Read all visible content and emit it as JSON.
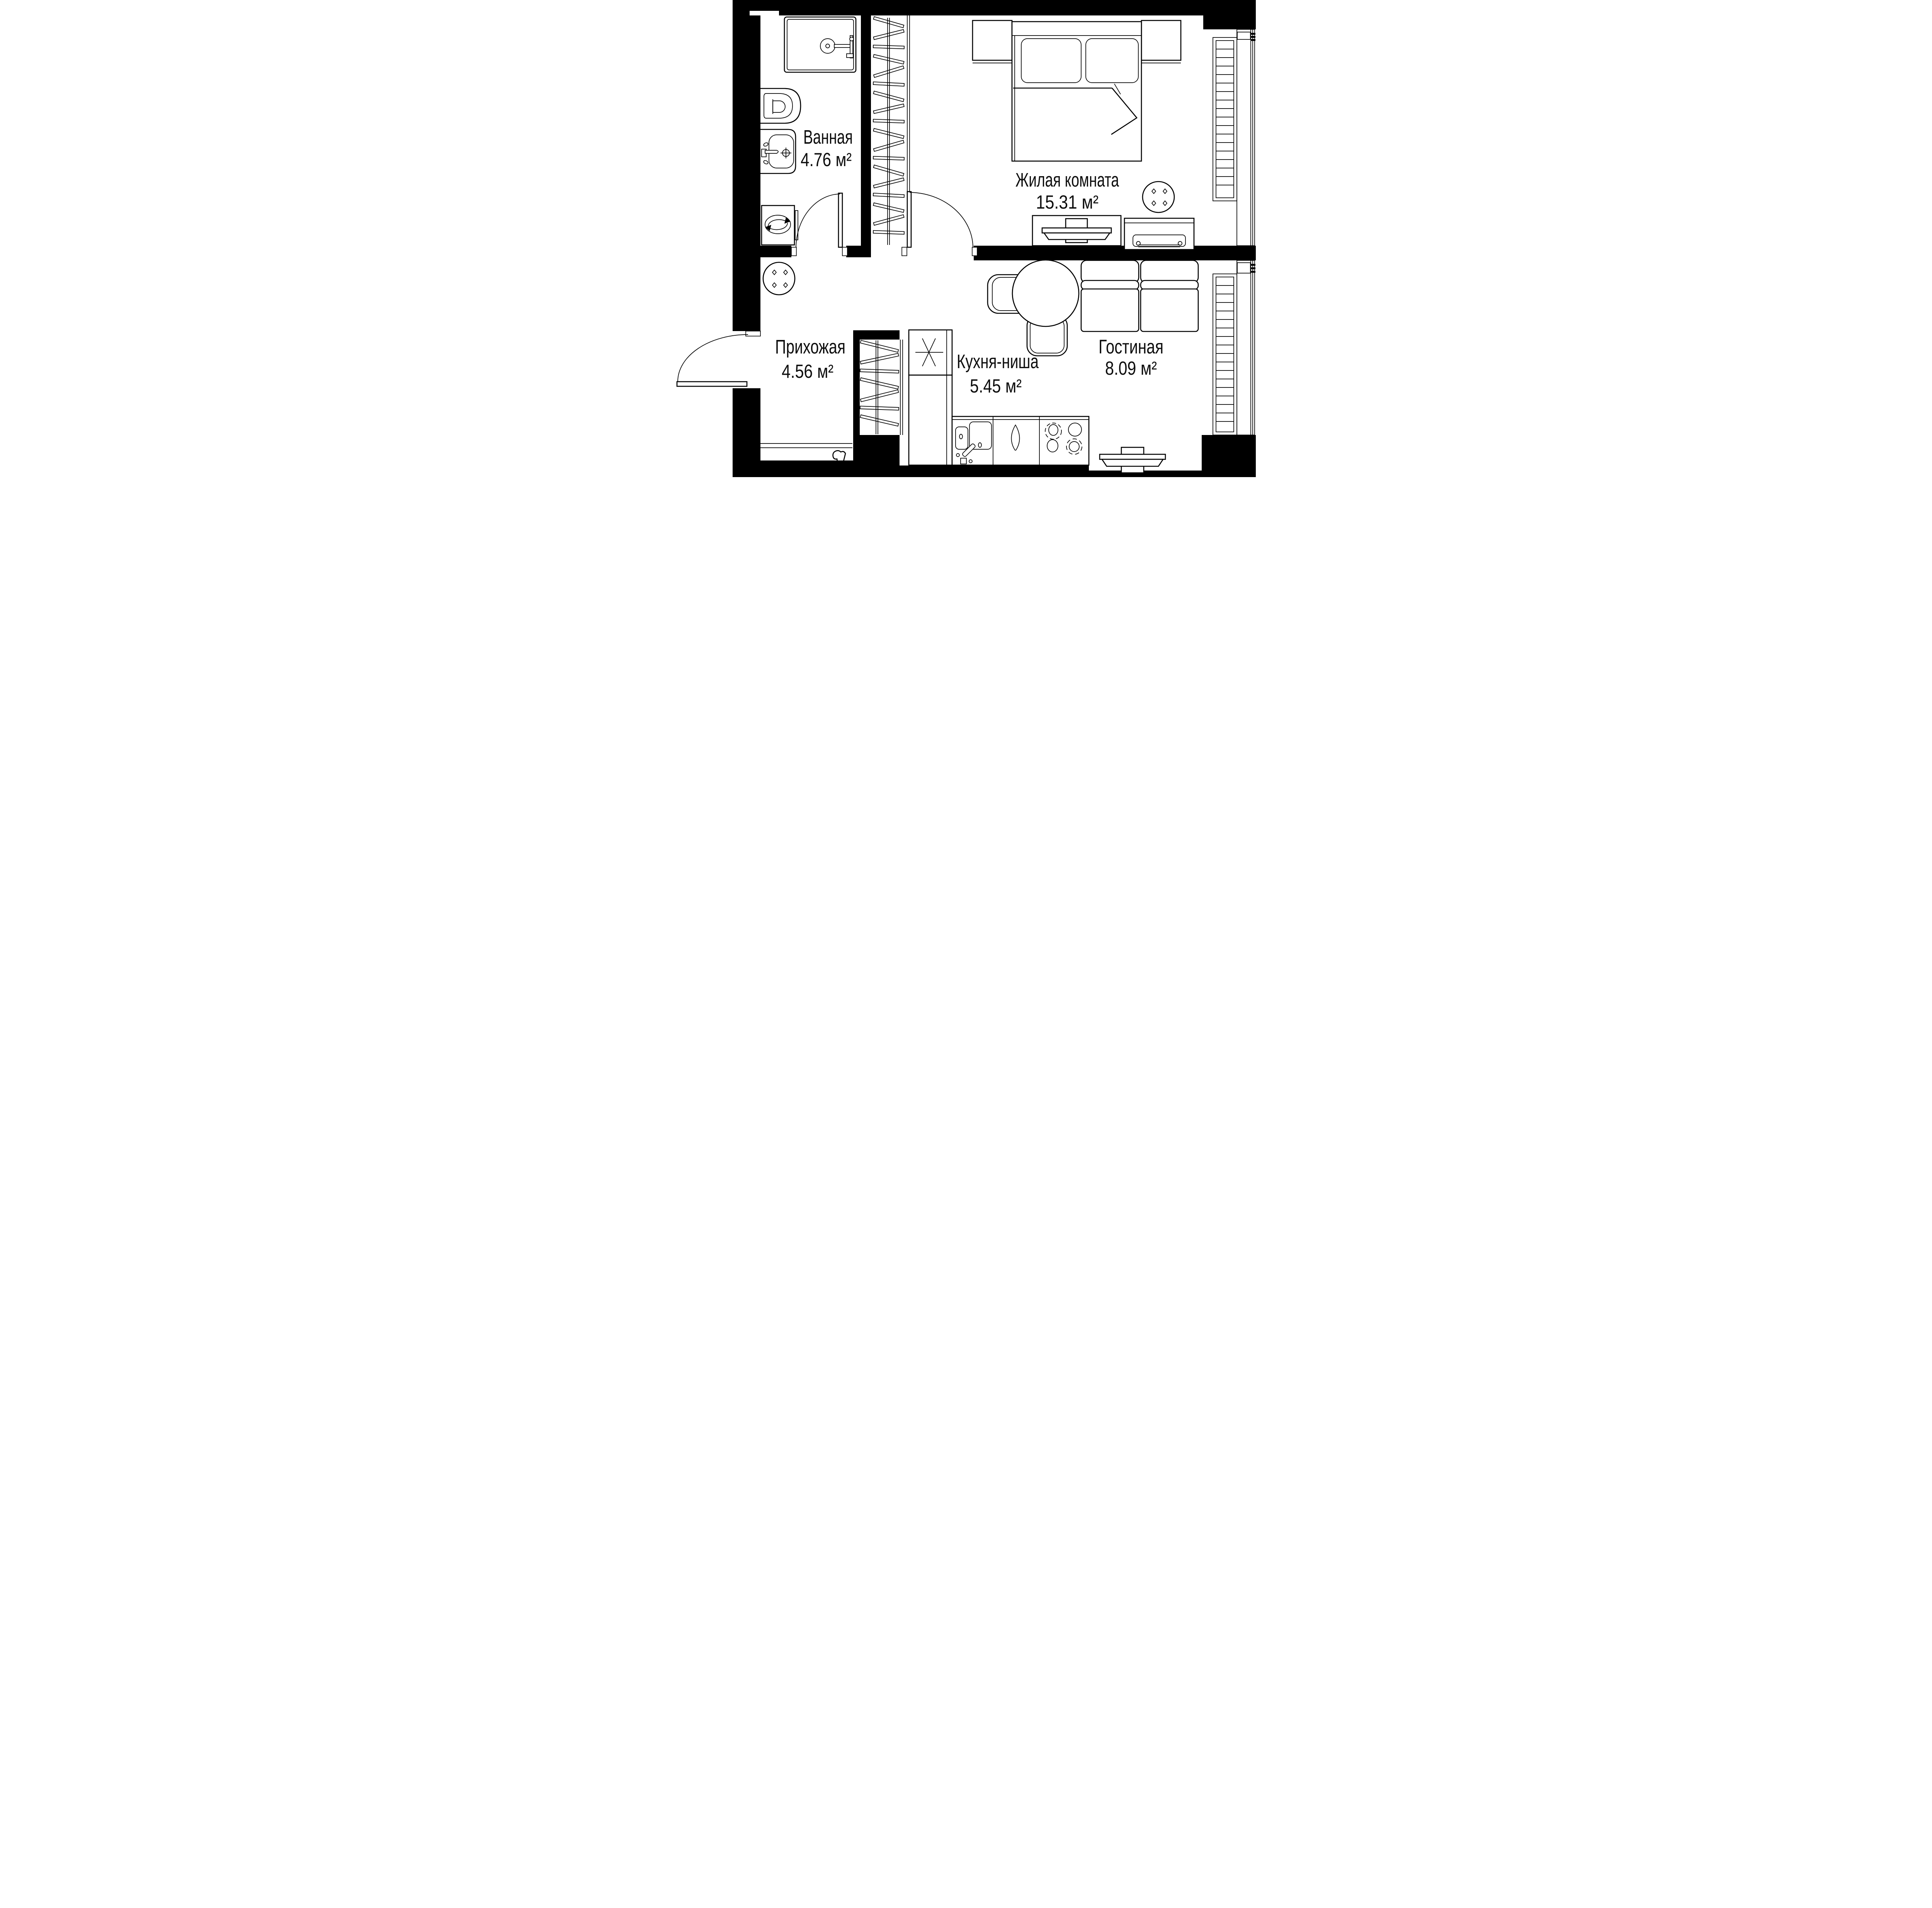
{
  "plan": {
    "title": "apartment-floor-plan",
    "rooms": [
      {
        "id": "bathroom",
        "name": "Ванная",
        "area": "4.76 м²"
      },
      {
        "id": "bedroom",
        "name": "Жилая комната",
        "area": "15.31 м²"
      },
      {
        "id": "hallway",
        "name": "Прихожая",
        "area": "4.56 м²"
      },
      {
        "id": "kitchen",
        "name": "Кухня-ниша",
        "area": "5.45 м²"
      },
      {
        "id": "living",
        "name": "Гостиная",
        "area": "8.09 м²"
      }
    ],
    "colors": {
      "walls": "#000000",
      "background": "#ffffff",
      "lines": "#000000"
    }
  }
}
